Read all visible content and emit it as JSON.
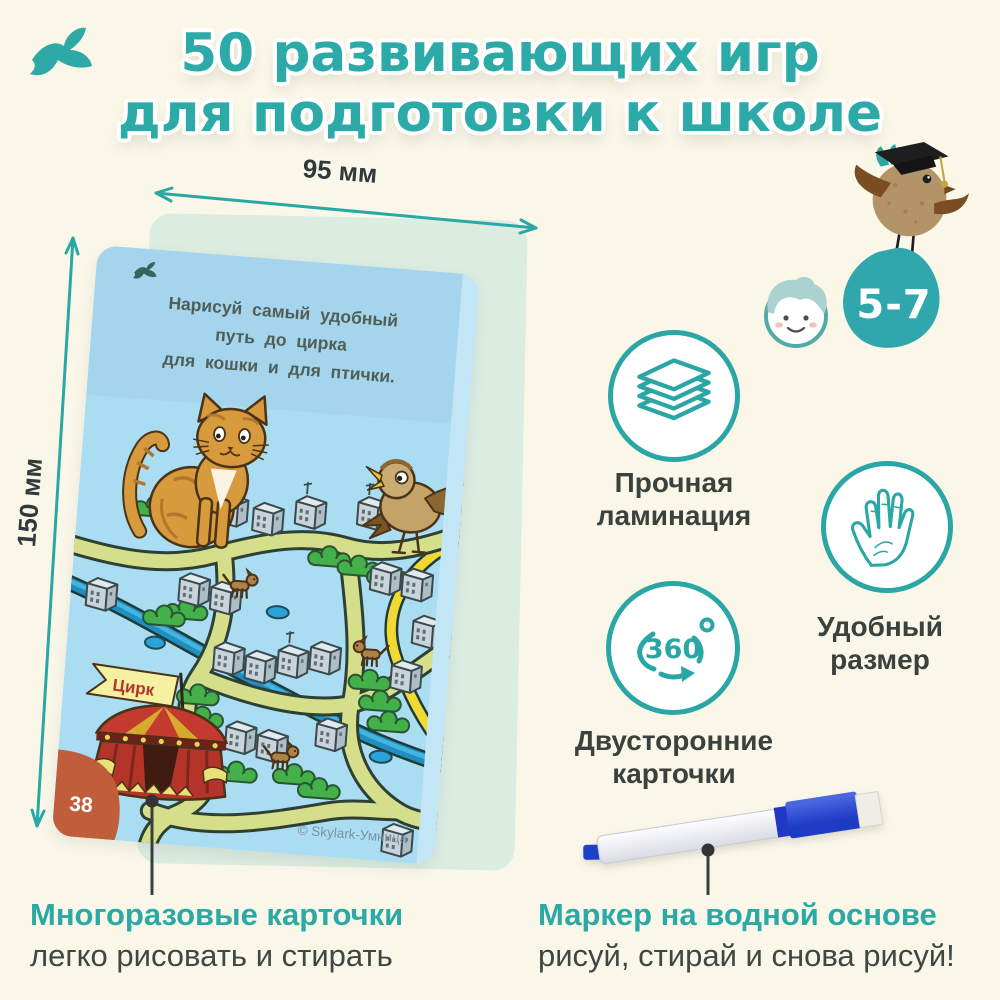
{
  "page": {
    "background": "#FAF7E9",
    "accent": "#2AA9A6",
    "dark_text": "#3D4744"
  },
  "brand": {
    "logo": "bird-logo"
  },
  "title": {
    "line1": "50 развивающих игр",
    "line2": "для подготовки к школе"
  },
  "dimensions": {
    "width": "95 мм",
    "height": "150 мм"
  },
  "card": {
    "task": {
      "line1": "Нарисуй самый удобный",
      "line2": "путь до цирка",
      "line3": "для кошки и для птички."
    },
    "map": {
      "flag": "Цирк"
    },
    "number": "38",
    "copyright": "© Skylark-Умница"
  },
  "age": {
    "badge": "5-7"
  },
  "features": [
    {
      "icon": "lamination-layers-icon",
      "line1": "Прочная",
      "line2": "ламинация"
    },
    {
      "icon": "hand-size-icon",
      "line1": "Удобный",
      "line2": "размер"
    },
    {
      "icon": "double-sided-360-icon",
      "label360": "360",
      "line1": "Двусторонние",
      "line2": "карточки"
    }
  ],
  "callouts": {
    "cards": {
      "title": "Многоразовые карточки",
      "subtitle": "легко рисовать и стирать"
    },
    "marker": {
      "title": "Маркер на водной основе",
      "subtitle": "рисуй, стирай и снова рисуй!"
    }
  }
}
